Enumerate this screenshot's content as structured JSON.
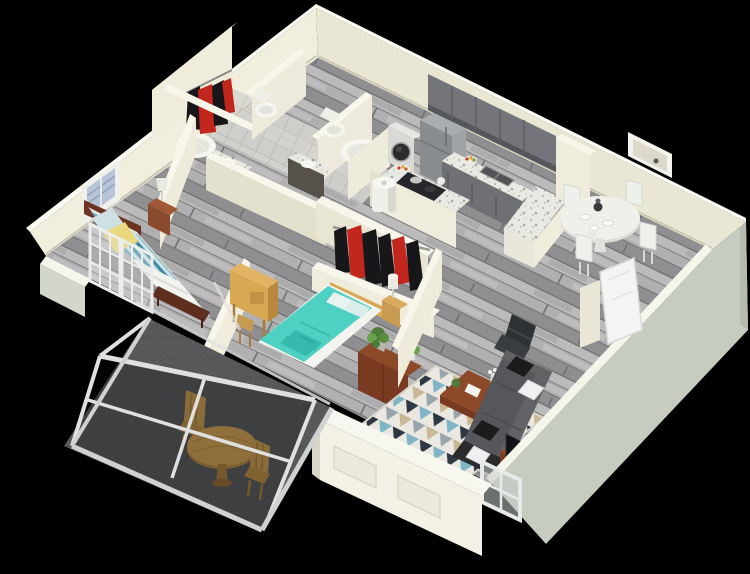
{
  "scene": {
    "title": "Two-bedroom apartment 3D floor plan render",
    "view": "isometric cutaway viewed from the south",
    "background": "#000000",
    "floor_finish": "gray wood plank",
    "rooms": [
      {
        "id": "bedroom-1",
        "label": "Bedroom 1",
        "items": [
          "queen bed with teal striped duvet and white throw",
          "yellow accent pillow",
          "dark wood headboard and foot bench",
          "nightstand with table lamp",
          "framed window art with blue blinds",
          "light oak desk with chair",
          "french doors to balcony"
        ]
      },
      {
        "id": "bathroom-1",
        "label": "Bathroom 1",
        "items": [
          "toilet",
          "oval bathtub",
          "dark vanity with sink"
        ]
      },
      {
        "id": "walk-in-closet-1",
        "label": "Walk-in closet 1",
        "items": [
          "hanging rod with red and black clothes"
        ]
      },
      {
        "id": "bathroom-2",
        "label": "Bathroom 2",
        "items": [
          "toilet",
          "round soaking tub",
          "dark vanity with sink"
        ]
      },
      {
        "id": "bedroom-2",
        "label": "Bedroom 2",
        "items": [
          "bed with turquoise duvet",
          "light wood headboard and nightstand with lamp",
          "open closet with red and black hanging clothes",
          "dark wood console with potted plants"
        ]
      },
      {
        "id": "laundry",
        "label": "Laundry nook",
        "items": [
          "front-load washer"
        ]
      },
      {
        "id": "utility",
        "label": "Utility closet",
        "items": [
          "water heater cylinder"
        ]
      },
      {
        "id": "kitchen",
        "label": "Kitchen",
        "items": [
          "gray upper cabinets",
          "gray lower cabinets",
          "refrigerator",
          "range with cookware and kettle",
          "double sink",
          "granite counters",
          "granite peninsula bar",
          "fruit plates"
        ]
      },
      {
        "id": "dining",
        "label": "Dining area",
        "items": [
          "round white pedestal table with place settings",
          "four white chairs",
          "recessed wall niche"
        ]
      },
      {
        "id": "living-room",
        "label": "Living room",
        "items": [
          "gray sectional sofa with black and white pillows",
          "wood coffee table with vase, plant and book",
          "geometric triangle rug",
          "black swivel chair",
          "wood media console with TV and bust sculpture",
          "entry door ajar",
          "window in low wall"
        ]
      },
      {
        "id": "balcony",
        "label": "Screened balcony",
        "items": [
          "concrete floor",
          "white aluminum screen enclosure",
          "round wood bistro table",
          "two wood folding chairs"
        ]
      }
    ]
  },
  "colors": {
    "background": "#000000",
    "wall_light": "#f1eede",
    "wall_mid": "#e9e6d4",
    "wall_top": "#f8f6ea",
    "wall_shadow": "#e3e0cd",
    "exterior_gray": "#c7ccc0",
    "floor_wood": "#a3a2a3",
    "tile_light": "#d6d5d0",
    "counter_granite": "#e9e9e3",
    "cabinet_gray": "#73757a",
    "appliance_gray": "#898c8f",
    "washer_white": "#d9d9d6",
    "bed1_teal": "#6fa9bd",
    "bed1_stripe_dark": "#3d8ba3",
    "bed1_stripe_light": "#cfe3e8",
    "pillow_yellow": "#e9d87e",
    "blanket_white": "#f3f3ef",
    "bed2_teal": "#4ed0c3",
    "headboard_wood": "#6b3422",
    "light_wood": "#d8a855",
    "dark_wood": "#7a3a22",
    "clothes_red": "#c3261c",
    "clothes_black": "#17171a",
    "sofa_gray": "#55575a",
    "pillow_black": "#1b1c1e",
    "pillow_white": "#eef0f1",
    "rug_base": "#eae8e0",
    "rug_navy": "#2e3742",
    "rug_teal": "#7fb5c6",
    "rug_tan": "#c9b795",
    "rug_gray": "#9aa6ad",
    "balcony_concrete": "#57585a",
    "balcony_wood": "#cfa055",
    "frame_white": "#dfe1e0",
    "fixture_white": "#f6f6f0",
    "plant_green": "#4e7d3a",
    "tv_black": "#121316",
    "table_white": "#f0f0eb"
  }
}
